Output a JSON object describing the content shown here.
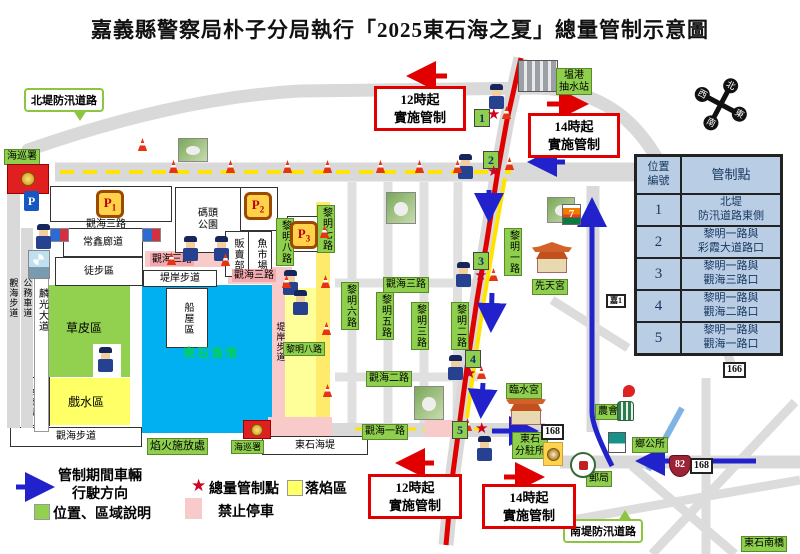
{
  "title": "嘉義縣警察局朴子分局執行「2025東石海之夏」總量管制示意圖",
  "legend": {
    "direction_l1": "管制期間車輛",
    "direction_l2": "行駛方向",
    "area_note": "位置、區域說明",
    "control_point": "總量管制點",
    "ember_zone": "落焰區",
    "no_parking": "禁止停車"
  },
  "notices": {
    "t12_l1": "12時起",
    "t12_l2": "實施管制",
    "t14_l1": "14時起",
    "t14_l2": "實施管制"
  },
  "control_table": {
    "header_no_l1": "位置",
    "header_no_l2": "編號",
    "header_point": "管制點",
    "rows": [
      {
        "no": "1",
        "l1": "北堤",
        "l2": "防汛道路東側"
      },
      {
        "no": "2",
        "l1": "黎明一路與",
        "l2": "彩霞大道路口"
      },
      {
        "no": "3",
        "l1": "黎明一路與",
        "l2": "觀海三路口"
      },
      {
        "no": "4",
        "l1": "黎明一路與",
        "l2": "觀海二路口"
      },
      {
        "no": "5",
        "l1": "黎明一路與",
        "l2": "觀海一路口"
      }
    ]
  },
  "control_points": {
    "p1": "1",
    "p2": "2",
    "p3": "3",
    "p4": "4",
    "p5": "5"
  },
  "roads": {
    "north_dike": "北堤防汛道路",
    "south_dike": "南堤防汛道路",
    "liming_1": "黎明一路",
    "liming_2": "黎明二路",
    "liming_3": "黎明三路",
    "liming_5": "黎明五路",
    "liming_6": "黎明六路",
    "liming_7": "黎明七路",
    "liming_8_v": "黎明八路",
    "liming_8_h": "黎明八路",
    "guanhai_1": "觀海一路",
    "guanhai_2": "觀海二路",
    "guanhai_3": "觀海三路",
    "guanhai_3_white": "觀海三路",
    "guanhai_3_pink1": "觀海三路",
    "guanhai_3_pink2": "觀海三路",
    "guanhai_walk_v": "觀海步道",
    "guanhai_walk_h": "觀海步道",
    "gongwu_lane": "公務車道",
    "linguang_ave": "麟光大道",
    "bank_walk_h": "堤岸步道",
    "bank_walk_v": "堤岸步道",
    "seawall": "東石海堤",
    "south_bridge": "東石南橋"
  },
  "places": {
    "coast_guard_top": "海巡署",
    "coast_guard_bottom": "海巡署",
    "pump_station_l1": "塭港",
    "pump_station_l2": "抽水站",
    "pier_park_l1": "碼頭",
    "pier_park_l2": "公園",
    "changxin_corridor": "常鑫廊道",
    "pedestrian_zone": "徒步區",
    "grass_zone": "草皮區",
    "oyster_house": "蚵殼屋",
    "water_play_zone": "戲水區",
    "boathouse_zone": "船屋區",
    "port_name": "東石漁港",
    "vendor": "販賣部",
    "fish_market": "魚市場",
    "xiantian_temple": "先天宮",
    "linshui_temple": "臨水宮",
    "fireworks_area": "焰火施放處",
    "substation_l1": "東石",
    "substation_l2": "分駐所",
    "farmers_assoc": "農會",
    "township_office": "鄉公所",
    "post_office": "郵局",
    "x6": "X6"
  },
  "signs": {
    "route_168_a": "168",
    "route_168_b": "168",
    "route_166": "166",
    "route_82": "82",
    "route_17": "17",
    "county_jia1": "嘉1",
    "seven": "7"
  },
  "parking": {
    "p": "P",
    "p1_main": "P",
    "p1_sub": "1",
    "p2_main": "P",
    "p2_sub": "2",
    "p3_main": "P",
    "p3_sub": "3"
  },
  "compass": {
    "n": "北",
    "e": "東",
    "s": "南",
    "w": "西"
  },
  "colors": {
    "green_label": "#8ed04d",
    "water": "#00b0f0",
    "ember_yellow": "#ffff99",
    "no_parking_pink": "#f8caca",
    "control_red": "#e00000",
    "flow_blue": "#2222cc",
    "table_bg": "#b9cde5"
  }
}
